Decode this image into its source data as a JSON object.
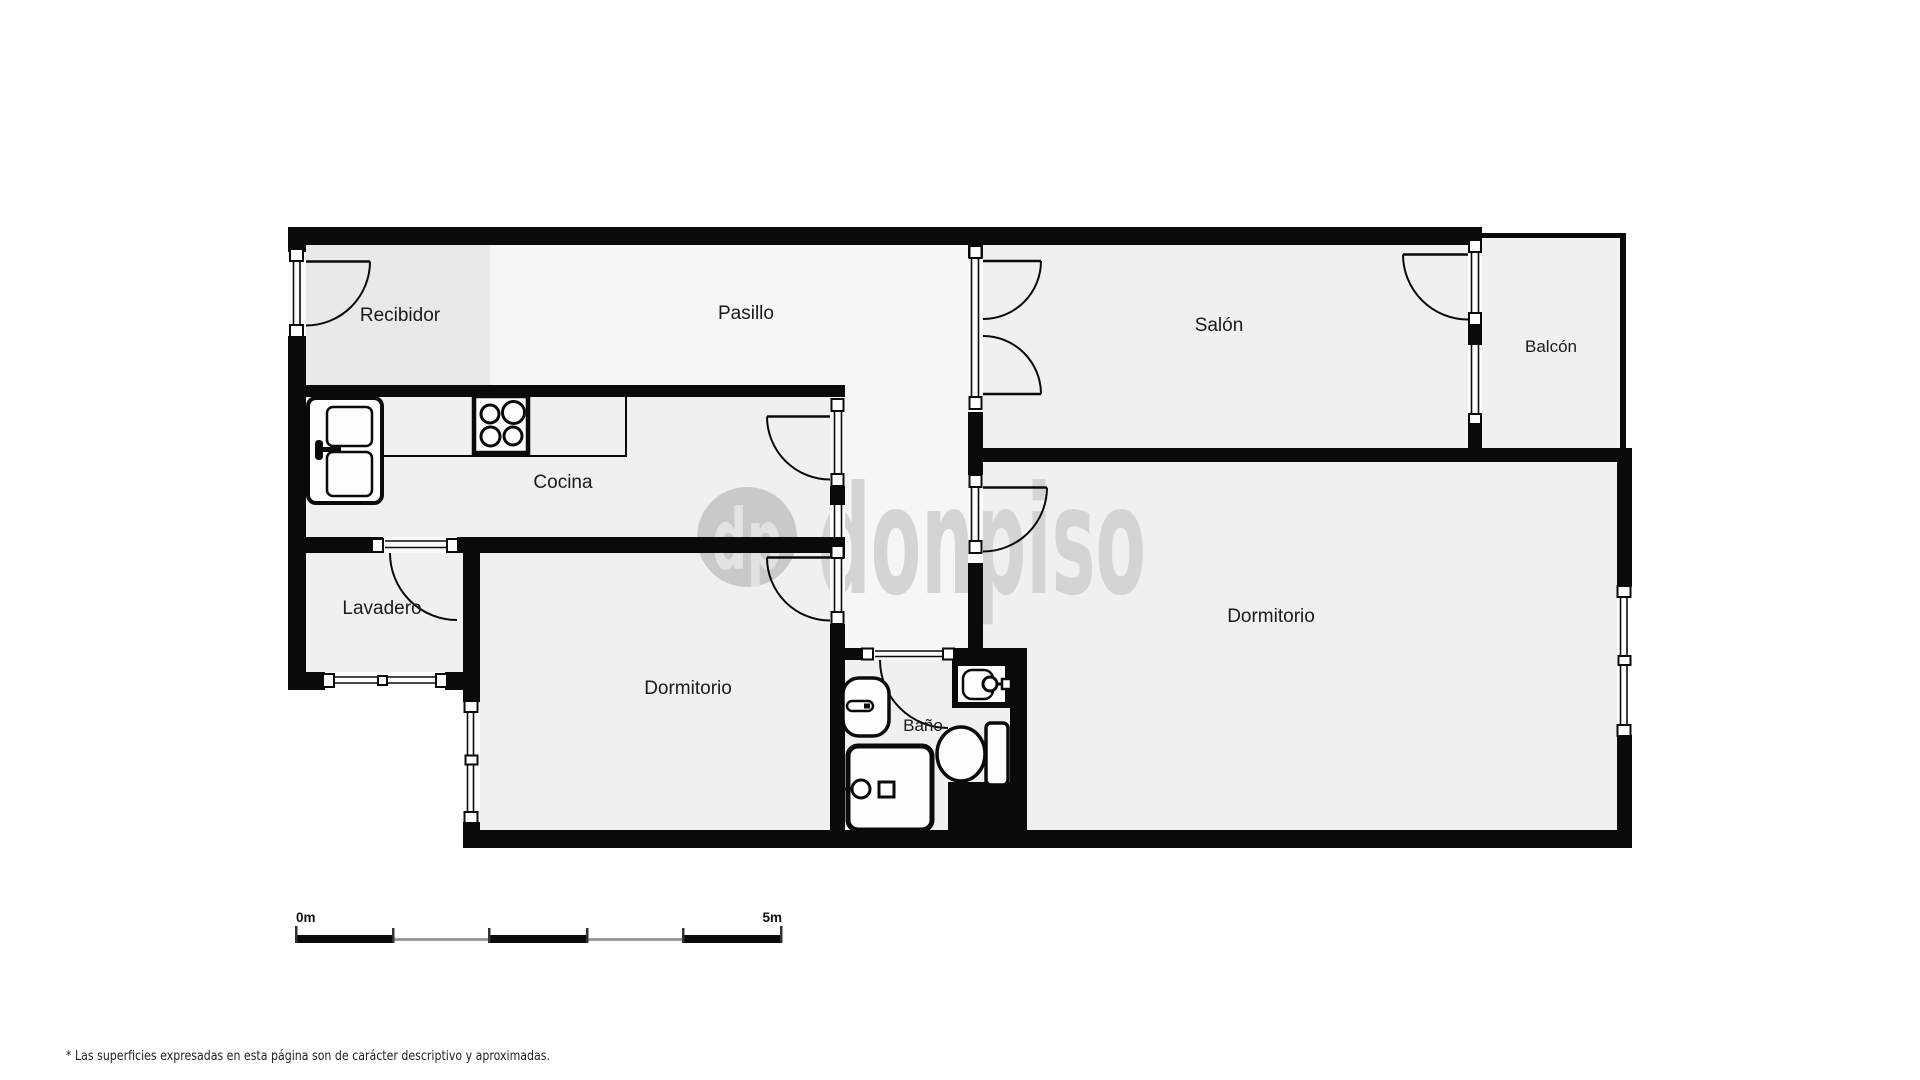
{
  "floorplan": {
    "rooms": {
      "recibidor": "Recibidor",
      "pasillo": "Pasillo",
      "salon": "Salón",
      "balcon": "Balcón",
      "cocina": "Cocina",
      "lavadero": "Lavadero",
      "dormitorio_left": "Dormitorio",
      "bano": "Baño",
      "dormitorio_right": "Dormitorio"
    },
    "colors": {
      "wall": "#0a0a0a",
      "room_floor": "#f0f0f0",
      "recibidor_floor": "#e9e9e9",
      "hallway_floor": "#f6f6f6",
      "label_text": "#1a1a1a",
      "background": "#ffffff"
    }
  },
  "watermark": {
    "logo_initials": "dp",
    "brand": "donpiso",
    "color": "#d4d4d4"
  },
  "scale_bar": {
    "start_label": "0m",
    "end_label": "5m",
    "segments": 5
  },
  "footnote": "* Las superficies expresadas en esta página son de carácter descriptivo y aproximadas."
}
